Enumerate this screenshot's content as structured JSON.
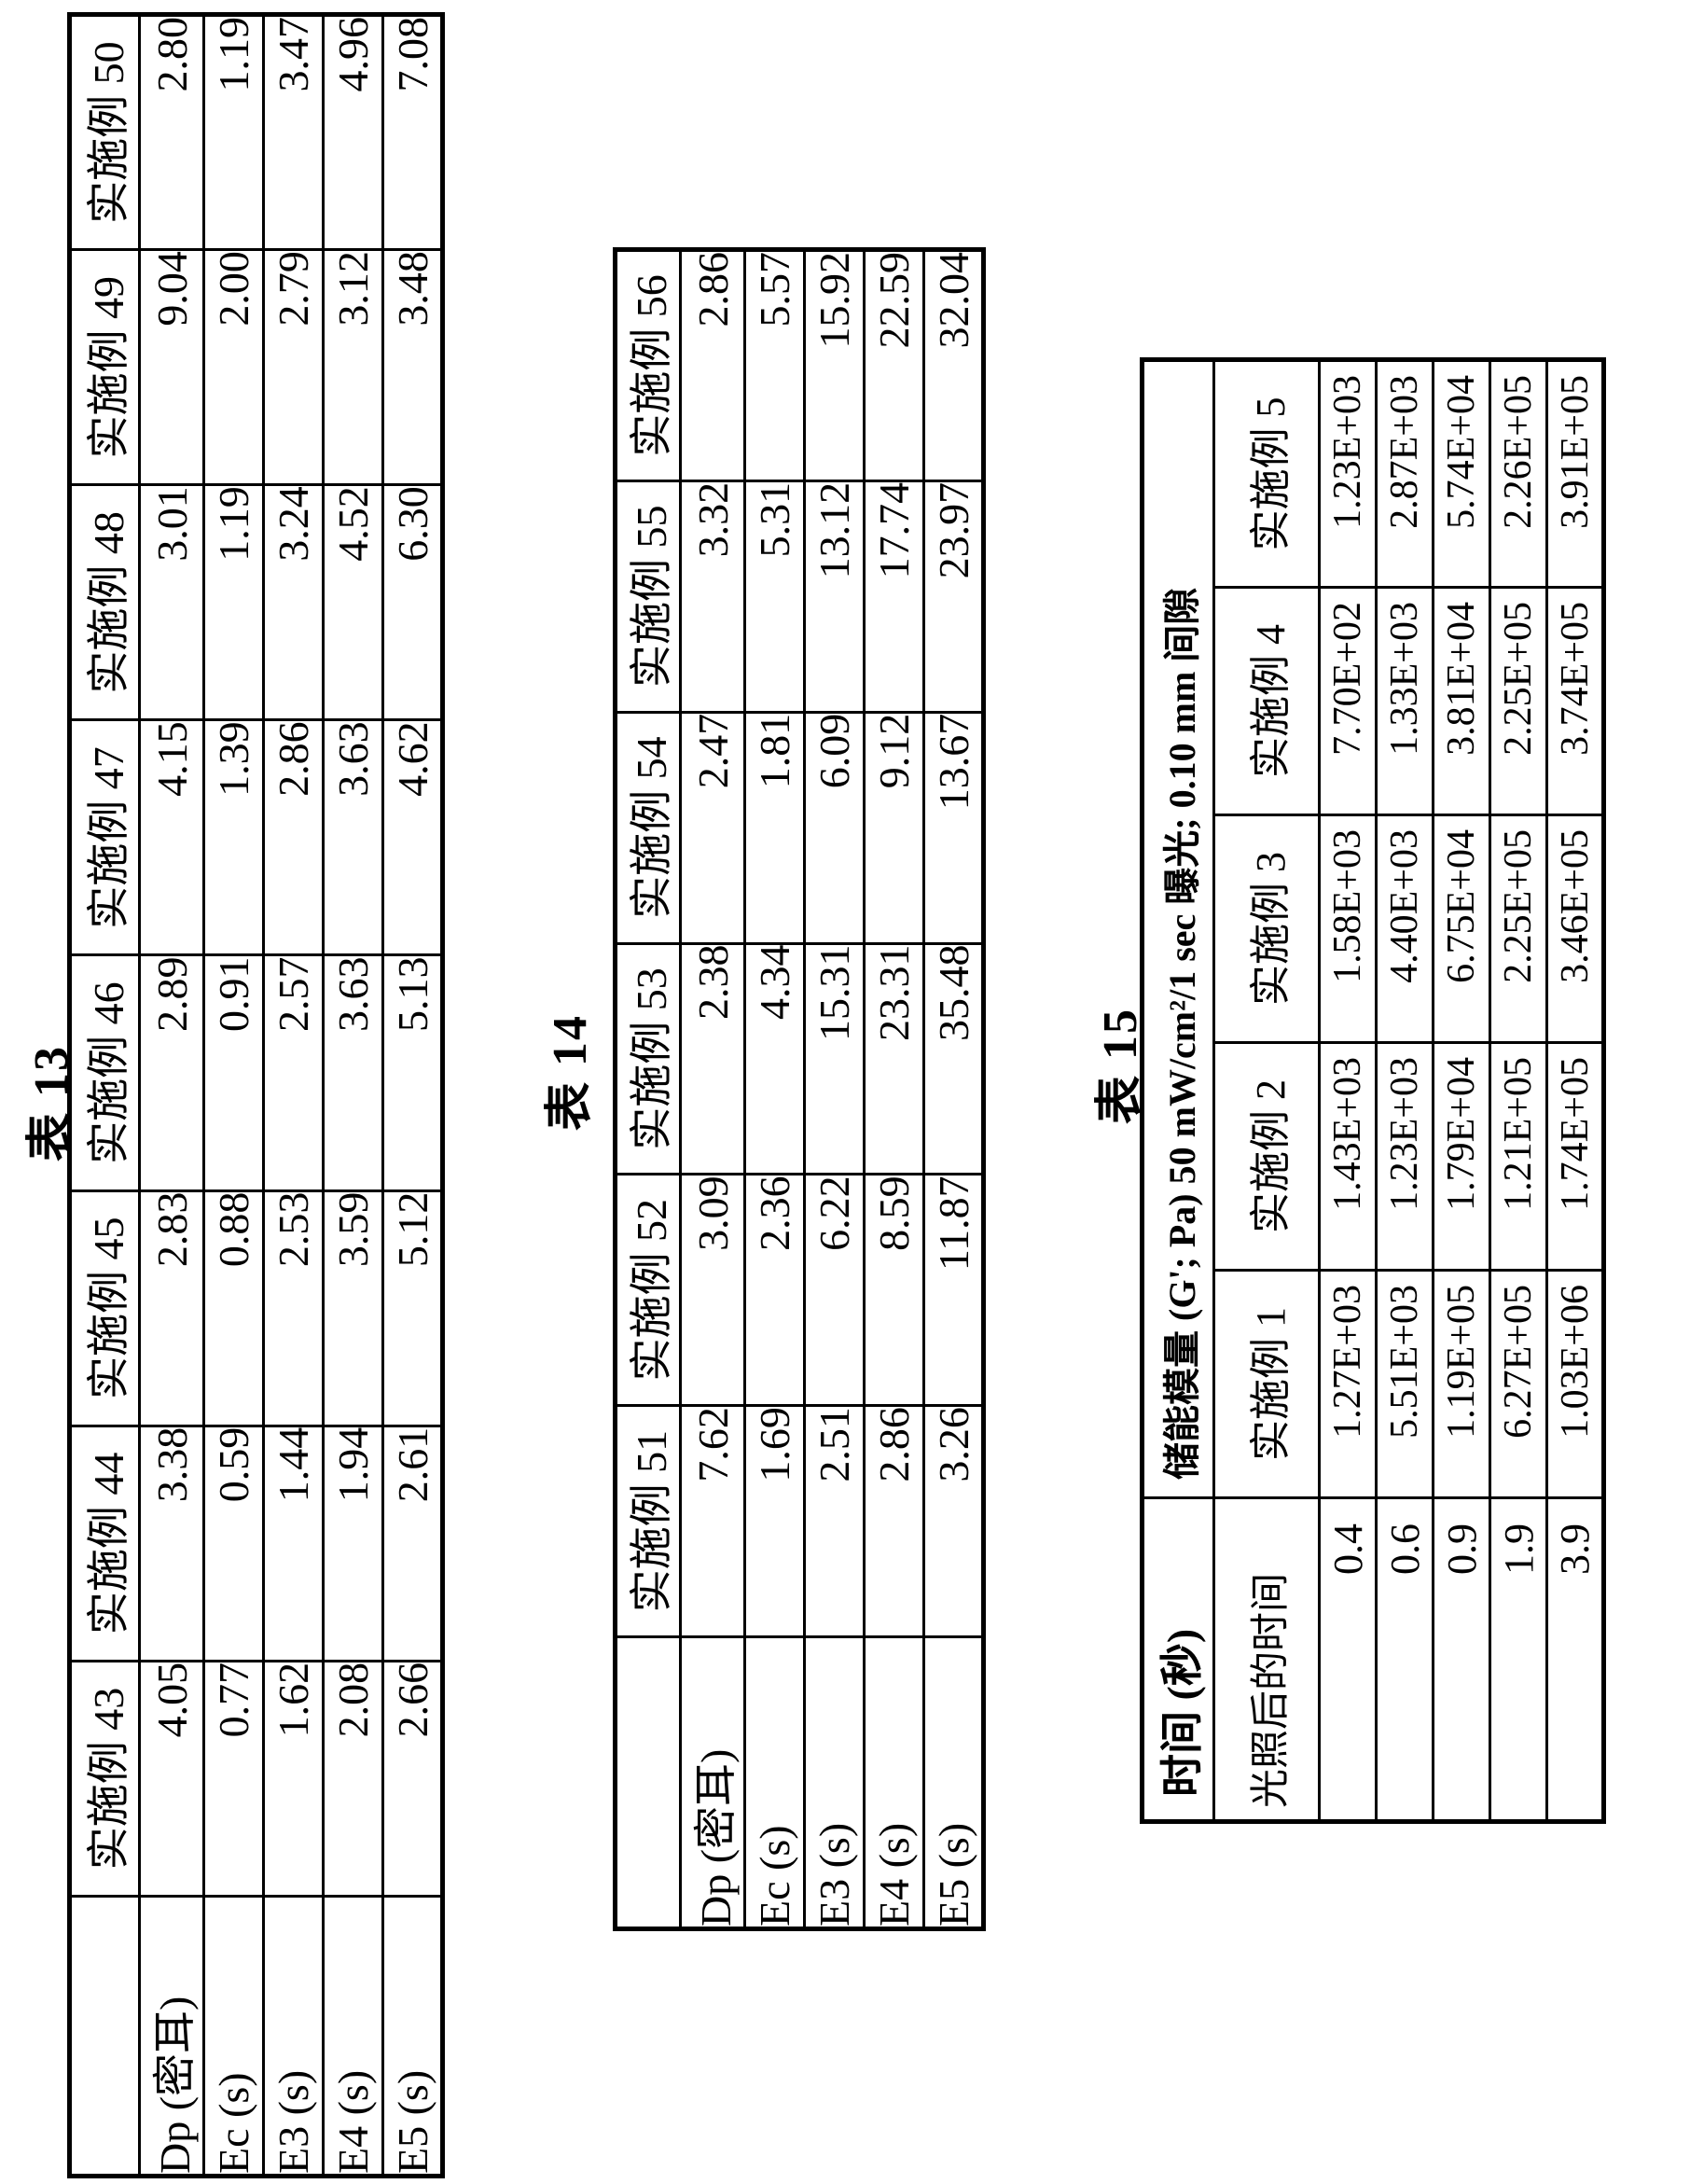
{
  "tables": {
    "t13": {
      "label": "表 13",
      "row_labels": [
        "Dp (密耳)",
        "Ec (s)",
        "E3 (s)",
        "E4 (s)",
        "E5 (s)"
      ],
      "columns": [
        {
          "name": "实施例 43",
          "values": [
            "4.05",
            "0.77",
            "1.62",
            "2.08",
            "2.66"
          ]
        },
        {
          "name": "实施例 44",
          "values": [
            "3.38",
            "0.59",
            "1.44",
            "1.94",
            "2.61"
          ]
        },
        {
          "name": "实施例 45",
          "values": [
            "2.83",
            "0.88",
            "2.53",
            "3.59",
            "5.12"
          ]
        },
        {
          "name": "实施例 46",
          "values": [
            "2.89",
            "0.91",
            "2.57",
            "3.63",
            "5.13"
          ]
        },
        {
          "name": "实施例 47",
          "values": [
            "4.15",
            "1.39",
            "2.86",
            "3.63",
            "4.62"
          ]
        },
        {
          "name": "实施例 48",
          "values": [
            "3.01",
            "1.19",
            "3.24",
            "4.52",
            "6.30"
          ]
        },
        {
          "name": "实施例 49",
          "values": [
            "9.04",
            "2.00",
            "2.79",
            "3.12",
            "3.48"
          ]
        },
        {
          "name": "实施例 50",
          "values": [
            "2.80",
            "1.19",
            "3.47",
            "4.96",
            "7.08"
          ]
        }
      ]
    },
    "t14": {
      "label": "表 14",
      "row_labels": [
        "Dp (密耳)",
        "Ec (s)",
        "E3 (s)",
        "E4 (s)",
        "E5 (s)"
      ],
      "columns": [
        {
          "name": "实施例 51",
          "values": [
            "7.62",
            "1.69",
            "2.51",
            "2.86",
            "3.26"
          ]
        },
        {
          "name": "实施例 52",
          "values": [
            "3.09",
            "2.36",
            "6.22",
            "8.59",
            "11.87"
          ]
        },
        {
          "name": "实施例 53",
          "values": [
            "2.38",
            "4.34",
            "15.31",
            "23.31",
            "35.48"
          ]
        },
        {
          "name": "实施例 54",
          "values": [
            "2.47",
            "1.81",
            "6.09",
            "9.12",
            "13.67"
          ]
        },
        {
          "name": "实施例 55",
          "values": [
            "3.32",
            "5.31",
            "13.12",
            "17.74",
            "23.97"
          ]
        },
        {
          "name": "实施例 56",
          "values": [
            "2.86",
            "5.57",
            "15.92",
            "22.59",
            "32.04"
          ]
        }
      ]
    },
    "t15": {
      "label": "表 15",
      "corner_label": "时间 (秒)",
      "merged_header": "储能模量 (G'; Pa) 50 mW/cm²/1 sec 曝光; 0.10 mm 间隙",
      "sub_label": "光照后的时间",
      "time_values": [
        "0.4",
        "0.6",
        "0.9",
        "1.9",
        "3.9"
      ],
      "columns": [
        {
          "name": "实施例 1",
          "values": [
            "1.27E+03",
            "5.51E+03",
            "1.19E+05",
            "6.27E+05",
            "1.03E+06"
          ]
        },
        {
          "name": "实施例 2",
          "values": [
            "1.43E+03",
            "1.23E+03",
            "1.79E+04",
            "1.21E+05",
            "1.74E+05"
          ]
        },
        {
          "name": "实施例 3",
          "values": [
            "1.58E+03",
            "4.40E+03",
            "6.75E+04",
            "2.25E+05",
            "3.46E+05"
          ]
        },
        {
          "name": "实施例 4",
          "values": [
            "7.70E+02",
            "1.33E+03",
            "3.81E+04",
            "2.25E+05",
            "3.74E+05"
          ]
        },
        {
          "name": "实施例 5",
          "values": [
            "1.23E+03",
            "2.87E+03",
            "5.74E+04",
            "2.26E+05",
            "3.91E+05"
          ]
        }
      ]
    }
  }
}
